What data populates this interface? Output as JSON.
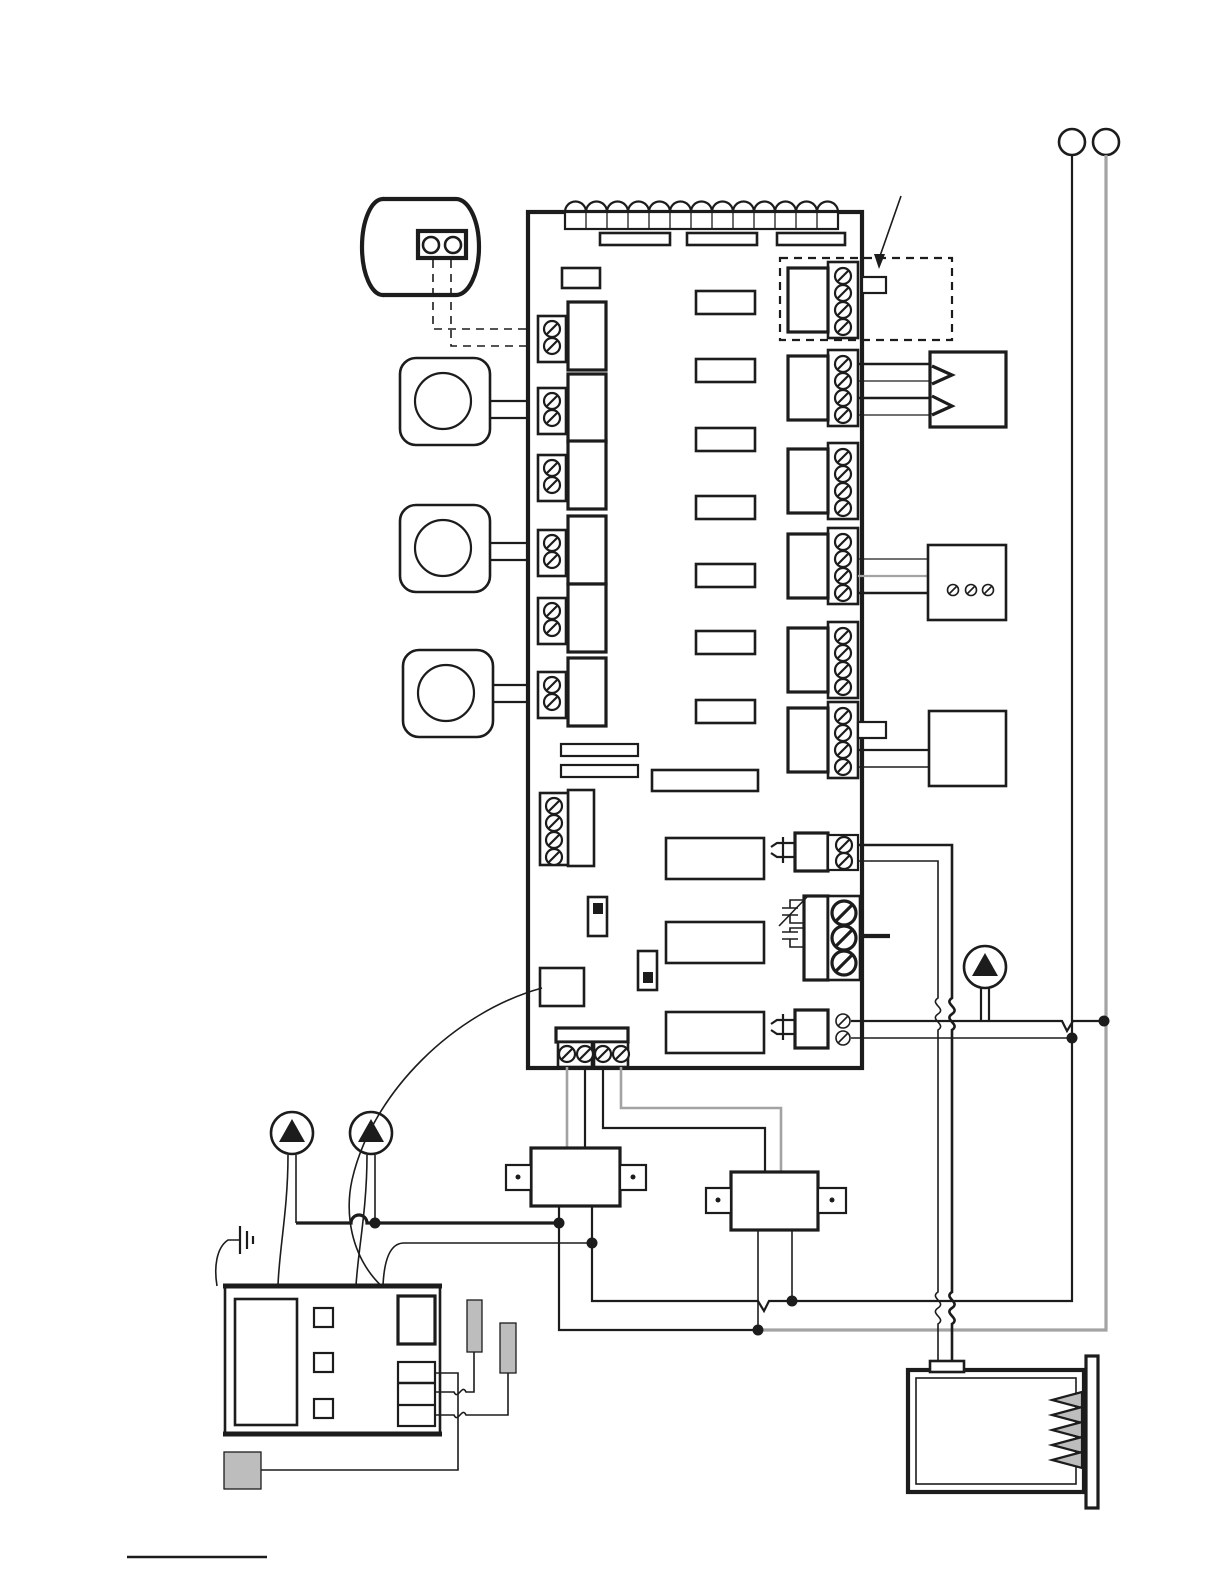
{
  "canvas": {
    "width": 1224,
    "height": 1584
  },
  "colors": {
    "line": "#1c1c1c",
    "gray_line": "#a3a3a3",
    "gray_fill": "#bdbdbd",
    "background": "#ffffff"
  },
  "components": {
    "diagram": "zone control wiring diagram",
    "tank": "storage tank with aquastat",
    "tank_wires": "tank aquastat leads dashed",
    "thermostat_1": "zone thermostat 1",
    "thermostat_2": "zone thermostat 2",
    "thermostat_3": "zone thermostat 3",
    "control_board": "zone control board",
    "led_strip": "status LED row",
    "left_terminals": "thermostat input terminal blocks",
    "right_terminals": "zone output terminal blocks",
    "dashed_callout": "priority zone dashed outline with pointer arrow",
    "plug_box": "end switch plug connector box",
    "screw_box": "zone valve screw terminal box",
    "aux_box": "auxiliary device box",
    "contact_top": "dry contact with fuse symbol",
    "power_terminal": "line voltage power terminal",
    "contact_bottom": "dry contact with fuse symbol",
    "bottom_terminal": "transformer supply terminal block",
    "transformer_1": "transformer 1",
    "transformer_2": "transformer 2",
    "pump_system": "system circulator pump",
    "pump_1": "circulator pump 1",
    "pump_2": "circulator pump 2",
    "ground": "earth ground symbol",
    "boiler_control": "boiler aquastat control",
    "sensor_1": "immersion well sensor 1",
    "sensor_2": "immersion well sensor 2",
    "junction_block": "junction block",
    "heater": "boiler with heating element",
    "hot_line": "line voltage conductor black",
    "neutral_line": "line voltage conductor gray",
    "line_terminals": "line voltage connection rings",
    "footer_rule": "footnote rule"
  }
}
